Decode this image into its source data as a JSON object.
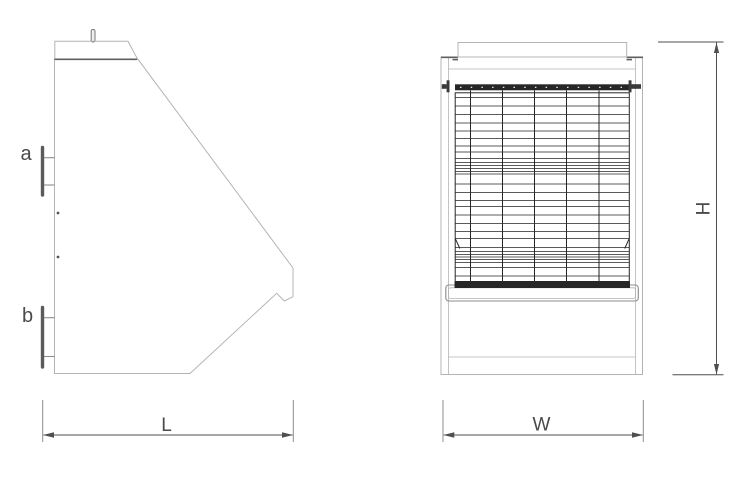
{
  "labels": {
    "a": "a",
    "b": "b"
  },
  "dimensions": {
    "length": "L",
    "width": "W",
    "height": "H"
  },
  "colors": {
    "line-light": "#b4b4b4",
    "line-mid": "#8c8c8c",
    "edge-dark": "#5f5f5f",
    "line-dark": "#262626",
    "dim-line": "#4f4f4f",
    "flange-dark": "#5a5a5a",
    "bolt-gray": "#3a3a3a",
    "label-text": "#4a4a4a"
  }
}
